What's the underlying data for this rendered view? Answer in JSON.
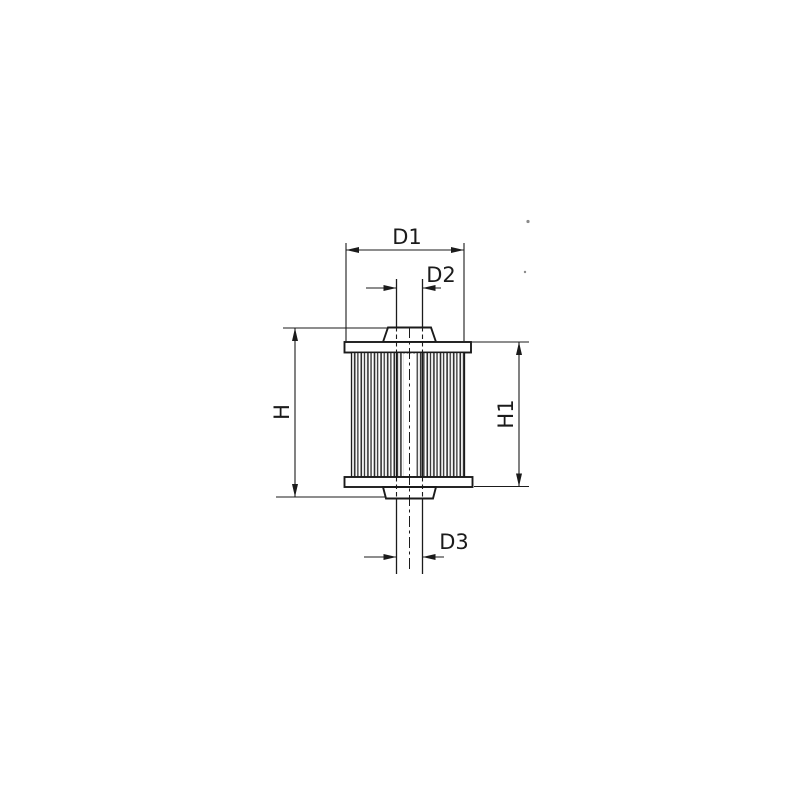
{
  "labels": {
    "d1": "D1",
    "d2": "D2",
    "d3": "D3",
    "h": "H",
    "h1": "H1"
  },
  "colors": {
    "ink": "#1b1b1b",
    "paper": "#ffffff",
    "pleat_stripe": "#2f2f2f",
    "speck": "#8a8a8a"
  }
}
